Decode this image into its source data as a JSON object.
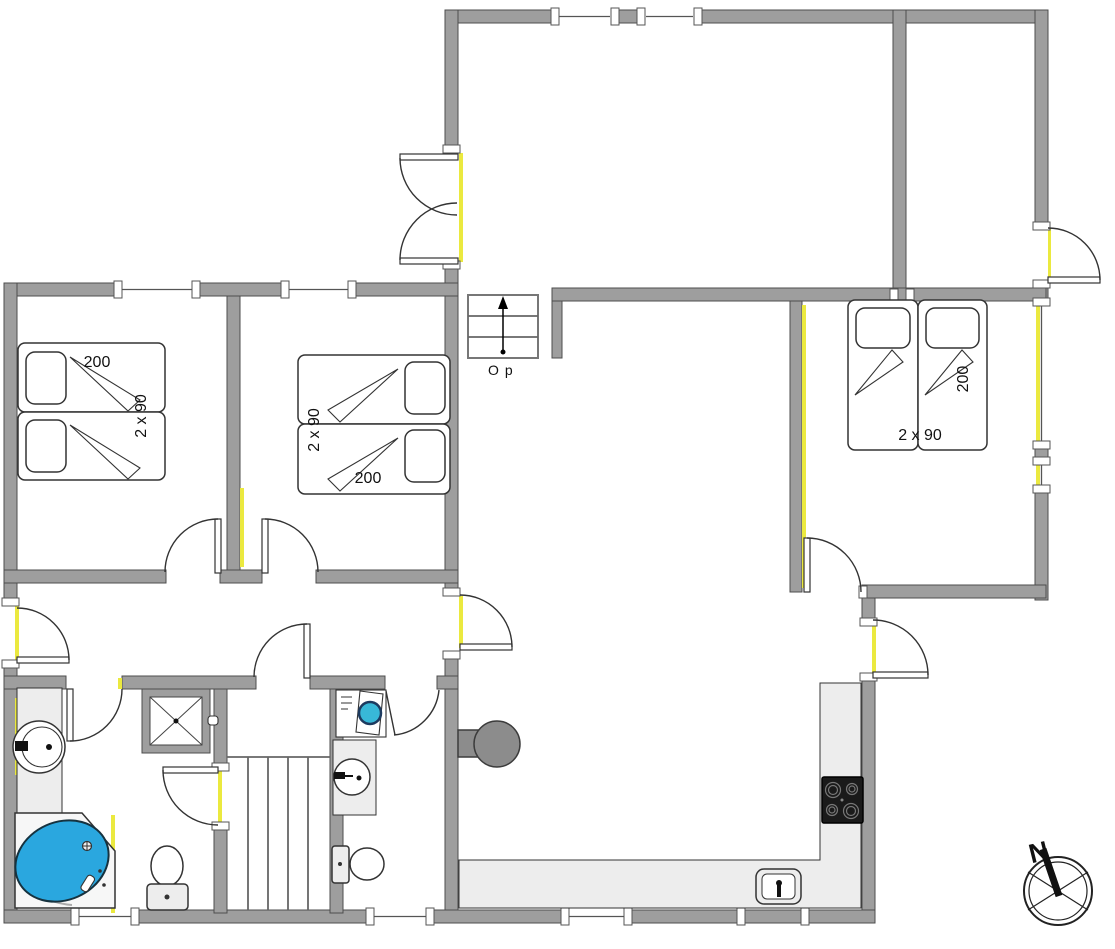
{
  "plan": {
    "bedroom_left": {
      "bed_length_label": "200",
      "bed_width_label": "2 x 90"
    },
    "bedroom_middle": {
      "bed_length_label": "200",
      "bed_width_label": "2 x 90"
    },
    "bedroom_right": {
      "bed_length_label": "200",
      "bed_width_label": "2 x 90"
    },
    "stairs_label": "Op",
    "compass_north_label": "N",
    "colors": {
      "wall": "#9e9e9e",
      "wall_outline": "#4d4d4d",
      "accent_yellow": "#ebe93f",
      "tub_blue": "#2aa7df",
      "washer_drum_teal": "#38b8d8",
      "counter": "#ededed",
      "stove": "#1a1a1a",
      "fireplace": "#8c8c8c",
      "door_line": "#333333"
    }
  }
}
